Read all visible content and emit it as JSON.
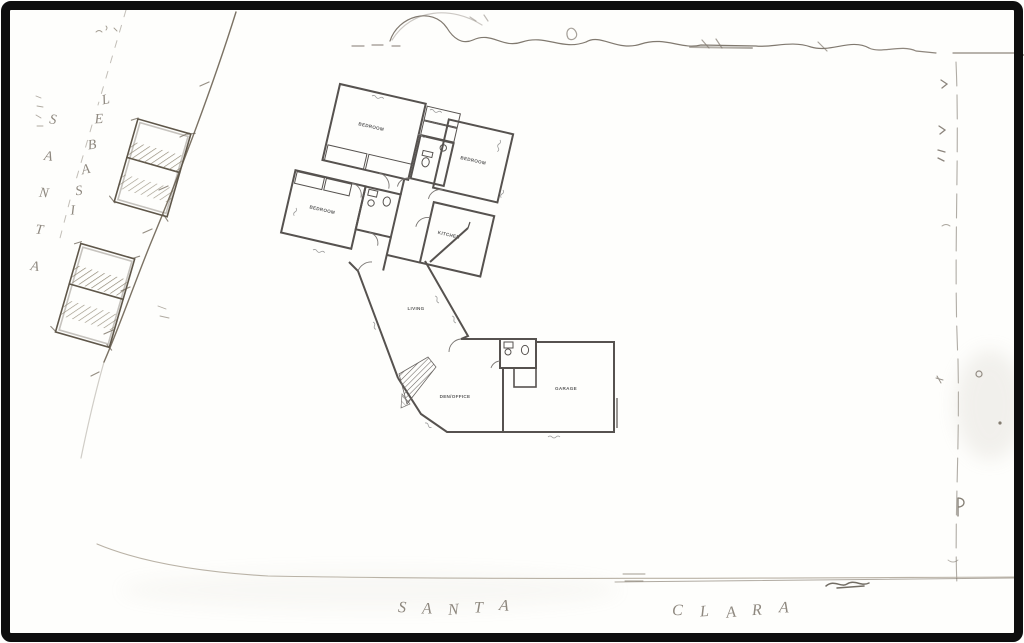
{
  "streets": {
    "left_name_vertical": "SANTA",
    "left_name_along": "ISABEL",
    "bottom_name_first": "SANTA",
    "bottom_name_second": "CLARA"
  },
  "rooms": {
    "bedroom_nw": "BEDROOM",
    "bedroom_ne": "BEDROOM",
    "bedroom_w": "BEDROOM",
    "kitchen": "KITCHEN",
    "living": "LIVING",
    "den_office": "DEN/OFFICE",
    "garage": "GARAGE"
  },
  "colors": {
    "frame": "#0e0e0e",
    "paper": "#fefefc",
    "wall_ink": "#56524f",
    "label_ink": "#5c5c5c",
    "pencil": "#8a8173",
    "pencil_dark": "#5f574a"
  }
}
